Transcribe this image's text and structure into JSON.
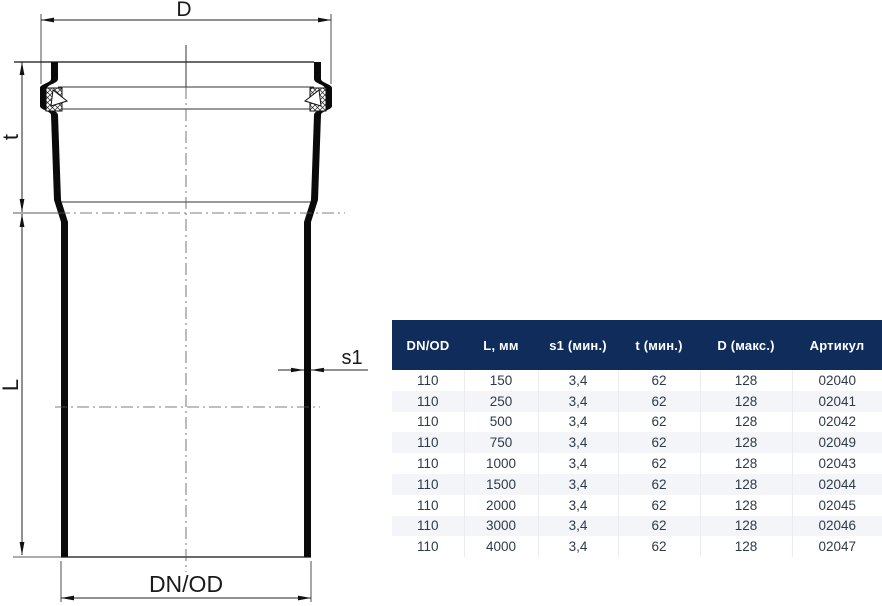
{
  "drawing": {
    "dimension_labels": {
      "outer_socket_diameter": "D",
      "socket_depth": "t",
      "pipe_length": "L",
      "wall_thickness": "s1",
      "nominal_outer_diameter": "DN/OD"
    }
  },
  "table": {
    "headers": [
      "DN/OD",
      "L, мм",
      "s1 (мин.)",
      "t (мин.)",
      "D (макс.)",
      "Артикул"
    ],
    "rows": [
      [
        "110",
        "150",
        "3,4",
        "62",
        "128",
        "02040"
      ],
      [
        "110",
        "250",
        "3,4",
        "62",
        "128",
        "02041"
      ],
      [
        "110",
        "500",
        "3,4",
        "62",
        "128",
        "02042"
      ],
      [
        "110",
        "750",
        "3,4",
        "62",
        "128",
        "02049"
      ],
      [
        "110",
        "1000",
        "3,4",
        "62",
        "128",
        "02043"
      ],
      [
        "110",
        "1500",
        "3,4",
        "62",
        "128",
        "02044"
      ],
      [
        "110",
        "2000",
        "3,4",
        "62",
        "128",
        "02045"
      ],
      [
        "110",
        "3000",
        "3,4",
        "62",
        "128",
        "02046"
      ],
      [
        "110",
        "4000",
        "3,4",
        "62",
        "128",
        "02047"
      ]
    ],
    "colors": {
      "header_bg": "#0f2c5a",
      "header_text": "#ffffff",
      "row_text": "#2e3a49",
      "stripe_bg": "#f3f5f8",
      "cell_line": "#e9edf1"
    }
  }
}
